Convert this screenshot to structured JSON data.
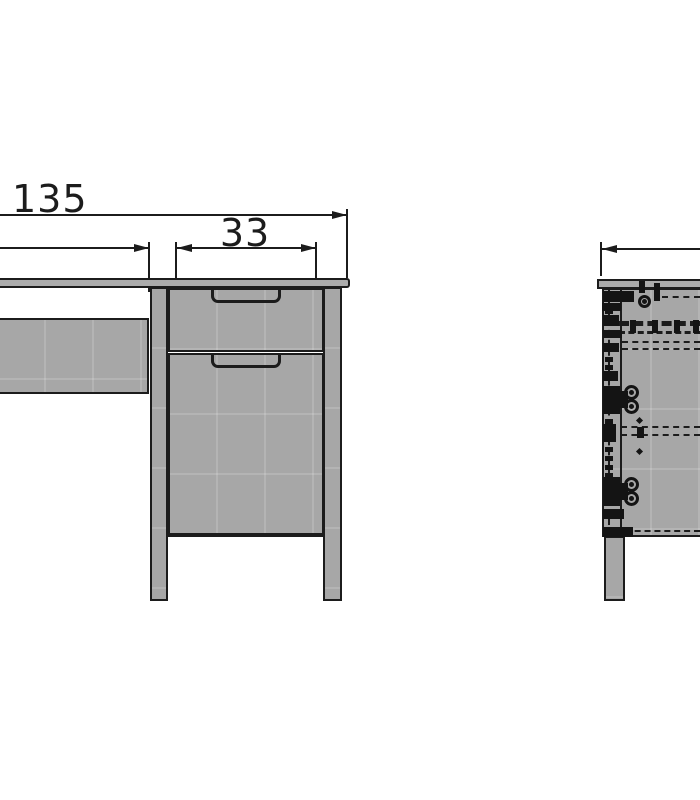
{
  "drawing": {
    "dimension_labels": {
      "total_width": "135",
      "drawer_width": "33"
    },
    "colors": {
      "background": "#ffffff",
      "line": "#1c1c1c",
      "panel_fill": "#a7a7a7",
      "desktop_fill": "#ababab",
      "hardware": "#141414"
    }
  }
}
